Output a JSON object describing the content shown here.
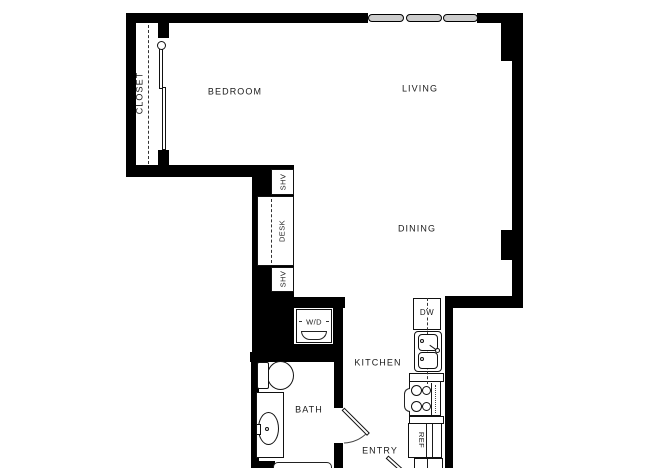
{
  "plan": {
    "rooms": {
      "closet": "CLOSET",
      "bedroom": "BEDROOM",
      "living": "LIVING",
      "dining": "DINING",
      "kitchen": "KITCHEN",
      "bath": "BATH",
      "entry": "ENTRY"
    },
    "fixtures": {
      "shelf_upper": "SHV",
      "desk": "DESK",
      "shelf_lower": "SHV",
      "washer_dryer": "W/D",
      "dishwasher": "DW",
      "refrigerator": "REF"
    },
    "colors": {
      "wall": "#000000",
      "background": "#ffffff",
      "line": "#1a1a1a",
      "window_fill": "#cccccc",
      "text": "#1a1a1a"
    }
  }
}
